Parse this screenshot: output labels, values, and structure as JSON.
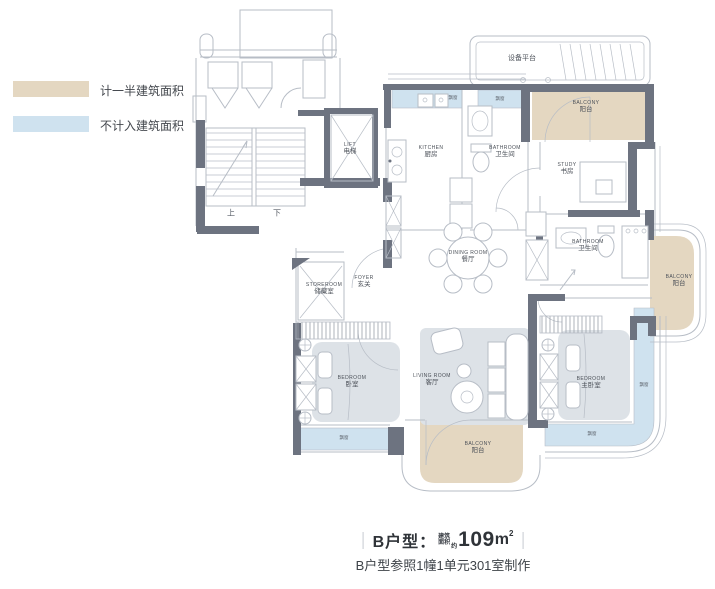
{
  "colors": {
    "counted_half": "#e4d7c1",
    "not_counted": "#cfe2ef",
    "wall": "#6d7380",
    "line": "#b7bdc6",
    "furniture": "#dde2e7"
  },
  "legend": {
    "items": [
      {
        "label": "计一半建筑面积",
        "color_key": "counted_half"
      },
      {
        "label": "不计入建筑面积",
        "color_key": "not_counted"
      }
    ]
  },
  "plan": {
    "rooms": [
      {
        "en": "KITCHEN",
        "cn": "厨房"
      },
      {
        "en": "BATHROOM",
        "cn": "卫生间"
      },
      {
        "en": "STUDY",
        "cn": "书房"
      },
      {
        "en": "BATHROOM",
        "cn": "卫生间"
      },
      {
        "en": "DINING ROOM",
        "cn": "餐厅"
      },
      {
        "en": "STOREROOM",
        "cn": "储藏室"
      },
      {
        "en": "FOYER",
        "cn": "玄关"
      },
      {
        "en": "BEDROOM",
        "cn": "卧室"
      },
      {
        "en": "LIVING ROOM",
        "cn": "客厅"
      },
      {
        "en": "BEDROOM",
        "cn": "主卧室"
      },
      {
        "en": "BALCONY",
        "cn": "阳台"
      },
      {
        "en": "BALCONY",
        "cn": "阳台"
      },
      {
        "en": "BALCONY",
        "cn": "阳台"
      },
      {
        "en": "LIFT",
        "cn": "电梯"
      }
    ],
    "annotations": {
      "equipment_platform": "设备平台",
      "stairs_up": "上",
      "stairs_down": "下",
      "bay_window": "飘窗"
    }
  },
  "caption": {
    "unit": "B户型：",
    "area_prefix_line1": "建筑",
    "area_prefix_line2": "面积",
    "area_approx": "约",
    "area_value": "109",
    "area_unit": "m",
    "area_sup": "2",
    "note": "B户型参照1幢1单元301室制作"
  }
}
